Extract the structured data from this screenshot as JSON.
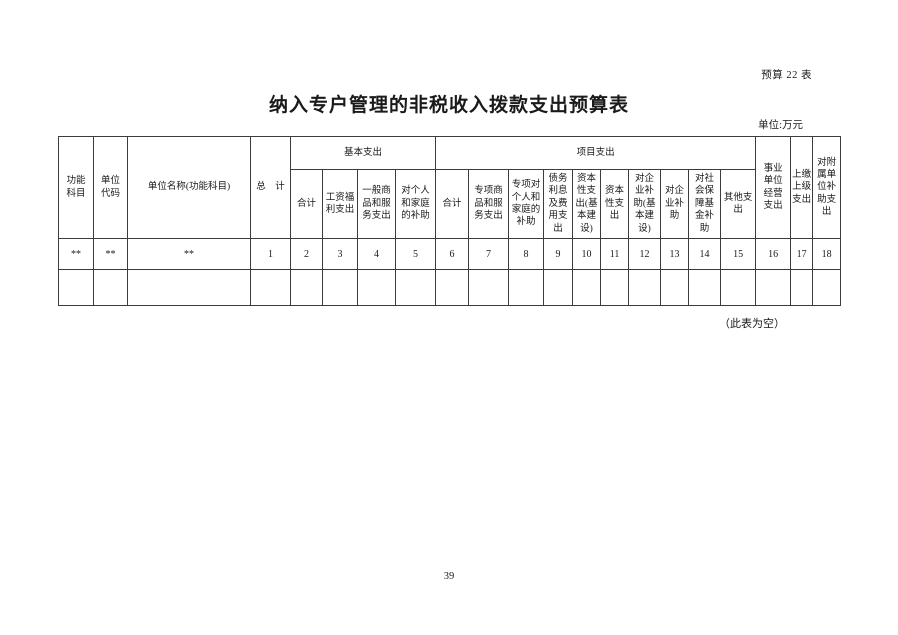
{
  "page": {
    "table_label": "预算 22 表",
    "title": "纳入专户管理的非税收入拨款支出预算表",
    "unit_note": "单位:万元",
    "empty_note": "（此表为空）",
    "page_number": "39"
  },
  "table": {
    "row_headers": {
      "func_subject": "功能\n科目",
      "unit_code": "单位\n代码",
      "unit_name": "单位名称(功能科目)",
      "grand_total": "总　计"
    },
    "groups": {
      "basic": "基本支出",
      "project": "项目支出"
    },
    "tail_headers": {
      "operating": "事业\n单位\n经营\n支出",
      "to_upper": "上缴\n上级\n支出",
      "affiliated": "对附\n属单\n位补\n助支\n出"
    },
    "basic_sub": [
      "合计",
      "工资福\n利支出",
      "一般商\n品和服\n务支出",
      "对个人\n和家庭\n的补助"
    ],
    "project_sub": [
      "合计",
      "专项商\n品和服\n务支出",
      "专项对\n个人和\n家庭的\n补助",
      "债务\n利息\n及费\n用支\n出",
      "资本\n性支\n出(基\n本建\n设)",
      "资本\n性支\n出",
      "对企\n业补\n助(基\n本建\n设)",
      "对企\n业补\n助",
      "对社\n会保\n障基\n金补\n助",
      "其他支\n出"
    ],
    "index_row": [
      "**",
      "**",
      "**",
      "1",
      "2",
      "3",
      "4",
      "5",
      "6",
      "7",
      "8",
      "9",
      "10",
      "11",
      "12",
      "13",
      "14",
      "15",
      "16",
      "17",
      "18"
    ]
  }
}
